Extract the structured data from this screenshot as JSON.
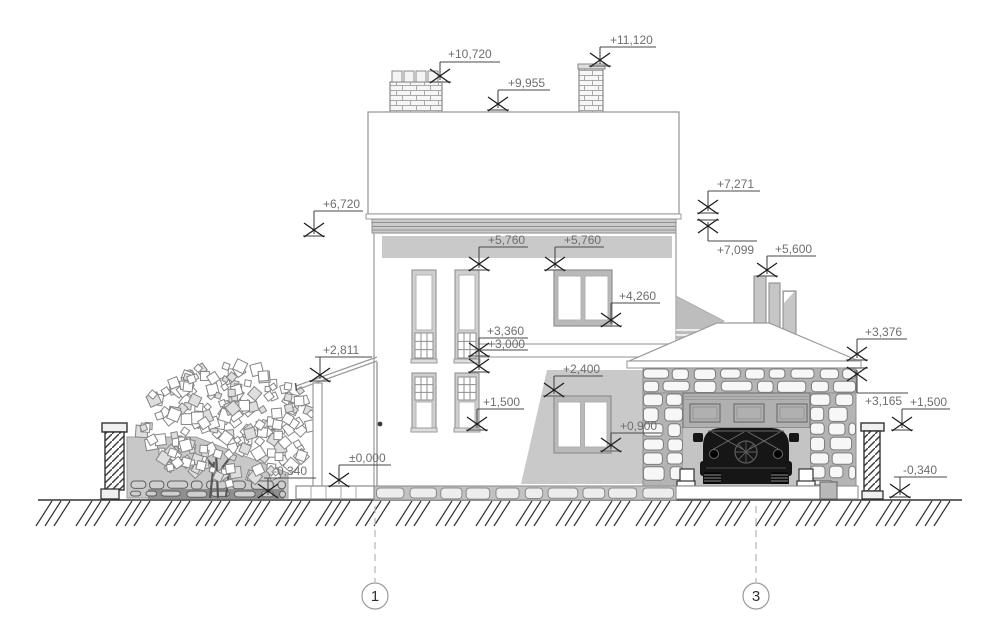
{
  "colors": {
    "outline": "#9a9a9a",
    "dark_line": "#333333",
    "marker_line": "#4a4a4a",
    "marker_bar": "#7d7d7d",
    "text": "#6e6e6e",
    "shadow": "#c9c9c9",
    "band": "#cbcbcb",
    "stone_bg": "#b4b4b4",
    "stone_fill": "#f2f2f2",
    "opening_bg": "#c4c4c4",
    "car": "#161616",
    "wall_fill": "#c8c8c8"
  },
  "elevation_markers": [
    {
      "label": "+10,720",
      "tx": 448,
      "ty": 58,
      "ux1": 440,
      "ux2": 500,
      "uy": 62,
      "lx": 440,
      "tipY": 82,
      "dir": "down"
    },
    {
      "label": "+9,955",
      "tx": 508,
      "ty": 87,
      "ux1": 498,
      "ux2": 550,
      "uy": 90,
      "lx": 498,
      "tipY": 110,
      "dir": "down"
    },
    {
      "label": "+11,120",
      "tx": 610,
      "ty": 44,
      "ux1": 600,
      "ux2": 656,
      "uy": 47,
      "lx": 600,
      "tipY": 66,
      "dir": "down"
    },
    {
      "label": "+6,720",
      "tx": 323,
      "ty": 208,
      "ux1": 314,
      "ux2": 363,
      "uy": 211,
      "lx": 314,
      "tipY": 236,
      "dir": "down"
    },
    {
      "label": "+5,760",
      "tx": 488,
      "ty": 244,
      "ux1": 479,
      "ux2": 528,
      "uy": 247,
      "lx": 479,
      "tipY": 270,
      "dir": "down"
    },
    {
      "label": "+5,760",
      "tx": 564,
      "ty": 244,
      "ux1": 555,
      "ux2": 604,
      "uy": 247,
      "lx": 555,
      "tipY": 270,
      "dir": "down"
    },
    {
      "label": "+4,260",
      "tx": 619,
      "ty": 300,
      "ux1": 611,
      "ux2": 660,
      "uy": 303,
      "lx": 611,
      "tipY": 326,
      "dir": "down"
    },
    {
      "label": "+3,360",
      "tx": 487,
      "ty": 335,
      "ux1": 479,
      "ux2": 528,
      "uy": 338,
      "lx": 479,
      "tipY": 356,
      "dir": "down"
    },
    {
      "label": "+3,000",
      "tx": 488,
      "ty": 348,
      "ux1": 479,
      "ux2": 528,
      "uy": 350,
      "lx": 479,
      "tipY": 372,
      "dir": "down"
    },
    {
      "label": "+1,500",
      "tx": 483,
      "ty": 406,
      "ux1": 477,
      "ux2": 524,
      "uy": 409,
      "lx": 477,
      "tipY": 430,
      "dir": "down"
    },
    {
      "label": "+2,400",
      "tx": 563,
      "ty": 373,
      "ux1": 554,
      "ux2": 603,
      "uy": 376,
      "lx": 554,
      "tipY": 396,
      "dir": "down"
    },
    {
      "label": "+0,900",
      "tx": 620,
      "ty": 430,
      "ux1": 611,
      "ux2": 662,
      "uy": 433,
      "lx": 611,
      "tipY": 451,
      "dir": "down"
    },
    {
      "label": "+7,271",
      "tx": 717,
      "ty": 188,
      "ux1": 708,
      "ux2": 760,
      "uy": 191,
      "lx": 708,
      "tipY": 213,
      "dir": "down"
    },
    {
      "label": "+7,099",
      "tx": 717,
      "ty": 254,
      "ux1": 708,
      "ux2": 757,
      "uy": 241,
      "lx": 708,
      "tipY": 220,
      "dir": "up"
    },
    {
      "label": "+5,600",
      "tx": 775,
      "ty": 253,
      "ux1": 767,
      "ux2": 816,
      "uy": 256,
      "lx": 767,
      "tipY": 276,
      "dir": "down"
    },
    {
      "label": "+3,376",
      "tx": 865,
      "ty": 336,
      "ux1": 857,
      "ux2": 907,
      "uy": 339,
      "lx": 857,
      "tipY": 360,
      "dir": "down"
    },
    {
      "label": "+3,165",
      "tx": 865,
      "ty": 405,
      "ux1": 857,
      "ux2": 908,
      "uy": 393,
      "lx": 857,
      "tipY": 368,
      "dir": "up"
    },
    {
      "label": "+1,500",
      "tx": 910,
      "ty": 406,
      "ux1": 902,
      "ux2": 950,
      "uy": 409,
      "lx": 902,
      "tipY": 430,
      "dir": "down"
    },
    {
      "label": "±0,000",
      "tx": 349,
      "ty": 462,
      "ux1": 339,
      "ux2": 391,
      "uy": 465,
      "lx": 339,
      "tipY": 486,
      "dir": "down"
    },
    {
      "label": "-0,340",
      "tx": 273,
      "ty": 475,
      "ux1": 264,
      "ux2": 316,
      "uy": 478,
      "lx": 268,
      "tipY": 497,
      "dir": "down"
    },
    {
      "label": "+2,811",
      "tx": 323,
      "ty": 354,
      "ux1": 315,
      "ux2": 372,
      "uy": 357,
      "lx": 320,
      "tipY": 381,
      "dir": "down"
    },
    {
      "label": "-0,340",
      "tx": 903,
      "ty": 474,
      "ux1": 894,
      "ux2": 947,
      "uy": 477,
      "lx": 900,
      "tipY": 497,
      "dir": "down"
    }
  ],
  "axes": [
    {
      "label": "1",
      "x": 375
    },
    {
      "label": "3",
      "x": 756
    }
  ]
}
